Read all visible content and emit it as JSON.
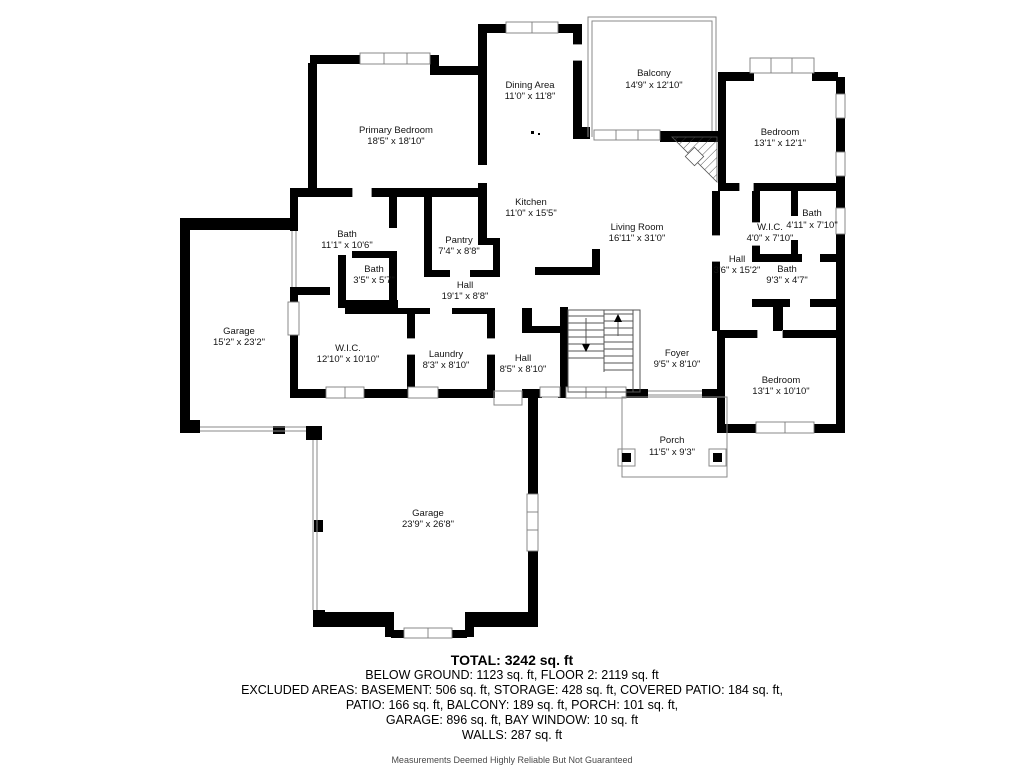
{
  "colors": {
    "wall": "#000000",
    "background": "#ffffff",
    "thin_line": "#8a8a8a"
  },
  "rooms": {
    "primary_bedroom": {
      "name": "Primary Bedroom",
      "dims": "18'5\" x 18'10\""
    },
    "dining_area": {
      "name": "Dining Area",
      "dims": "11'0\" x 11'8\""
    },
    "balcony": {
      "name": "Balcony",
      "dims": "14'9\" x 12'10\""
    },
    "bedroom_top_right": {
      "name": "Bedroom",
      "dims": "13'1\" x 12'1\""
    },
    "kitchen": {
      "name": "Kitchen",
      "dims": "11'0\" x 15'5\""
    },
    "living_room": {
      "name": "Living Room",
      "dims": "16'11\" x 31'0\""
    },
    "pantry": {
      "name": "Pantry",
      "dims": "7'4\" x 8'8\""
    },
    "bath_upper_left": {
      "name": "Bath",
      "dims": "11'1\" x 10'6\""
    },
    "bath_small_left": {
      "name": "Bath",
      "dims": "3'5\" x 5'7\""
    },
    "hall_upper": {
      "name": "Hall",
      "dims": "19'1\" x 8'8\""
    },
    "garage_left": {
      "name": "Garage",
      "dims": "15'2\" x 23'2\""
    },
    "wic_left": {
      "name": "W.I.C.",
      "dims": "12'10\" x 10'10\""
    },
    "laundry": {
      "name": "Laundry",
      "dims": "8'3\" x 8'10\""
    },
    "hall_lower": {
      "name": "Hall",
      "dims": "8'5\" x 8'10\""
    },
    "foyer": {
      "name": "Foyer",
      "dims": "9'5\" x 8'10\""
    },
    "wic_right": {
      "name": "W.I.C.",
      "dims": "4'0\" x 7'10\""
    },
    "bath_right_upper": {
      "name": "Bath",
      "dims": "4'11\" x 7'10\""
    },
    "hall_right": {
      "name": "Hall",
      "dims": "3'6\" x 15'2\""
    },
    "bath_right_lower": {
      "name": "Bath",
      "dims": "9'3\" x 4'7\""
    },
    "bedroom_bottom_right": {
      "name": "Bedroom",
      "dims": "13'1\" x 10'10\""
    },
    "porch": {
      "name": "Porch",
      "dims": "11'5\" x 9'3\""
    },
    "garage_main": {
      "name": "Garage",
      "dims": "23'9\" x 26'8\""
    }
  },
  "summary": {
    "total": "TOTAL: 3242 sq. ft",
    "line1": "BELOW GROUND: 1123 sq. ft, FLOOR 2: 2119 sq. ft",
    "line2": "EXCLUDED AREAS: BASEMENT: 506 sq. ft, STORAGE: 428 sq. ft, COVERED PATIO: 184 sq. ft,",
    "line3": "PATIO: 166 sq. ft, BALCONY: 189 sq. ft, PORCH: 101 sq. ft,",
    "line4": "GARAGE: 896 sq. ft, BAY WINDOW: 10 sq. ft",
    "line5": "WALLS: 287 sq. ft",
    "disclaimer": "Measurements Deemed Highly Reliable But Not Guaranteed"
  }
}
